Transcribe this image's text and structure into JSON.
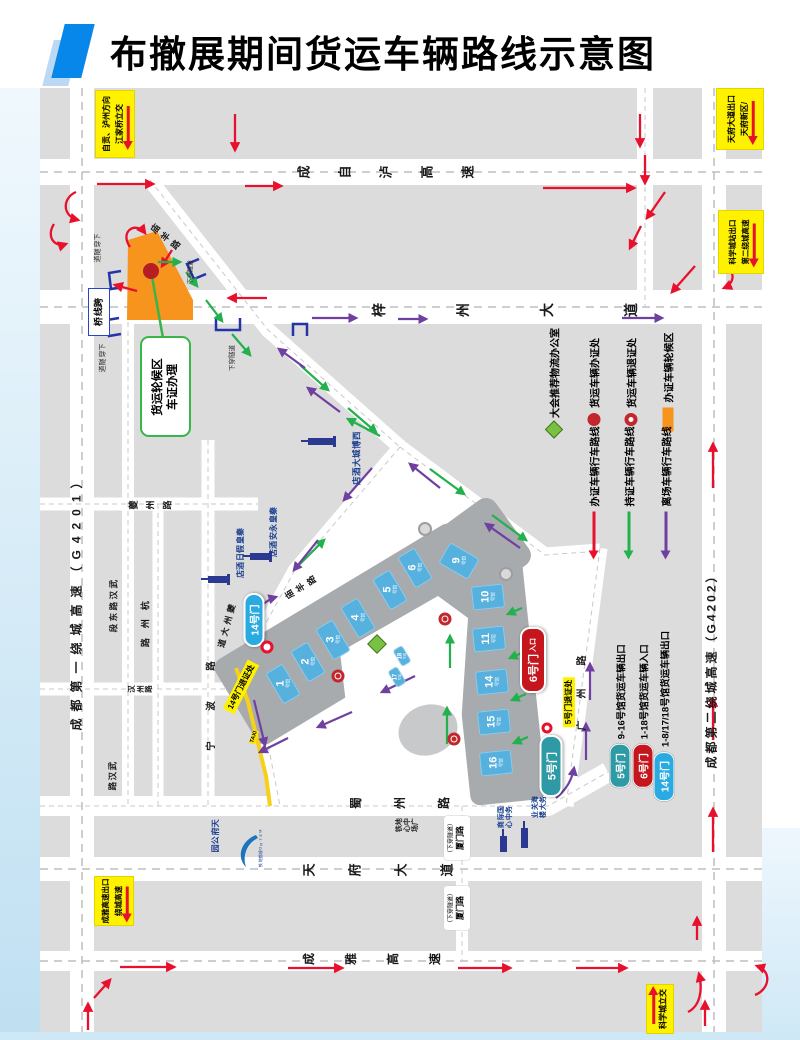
{
  "title": {
    "text": "布撤展期间货运车辆路线示意图"
  },
  "roads": {
    "chengzilu": "成自泸高速",
    "zizhou": "梓州大道",
    "g4201": "成都第一绕城高速（G4201）",
    "g4202": "成都第二绕城高速（G4202）",
    "wuhan_east": "武汉路东段",
    "wuhan": "武汉路",
    "kuizhou_rd": "夔州路",
    "hangzhou": "杭州路",
    "hanzhou": "汉州路",
    "ningbo": "宁波路",
    "kuizhou_ave": "夔州大道",
    "miaoyang": "庙羊路",
    "guangzhou": "广州路",
    "shuzhou": "蜀州路",
    "tianfu": "天府大道",
    "chengya": "成雅高速"
  },
  "exit_labels": {
    "jiangjiaqiao": {
      "lines": [
        "江家桥立交",
        "自贡、泸州方向"
      ]
    },
    "tianfu_exit": {
      "lines": [
        "天府新区/",
        "天府大道出口"
      ]
    },
    "second_ring_exit": {
      "lines": [
        "第二绕城高速",
        "科学城站出口"
      ]
    },
    "chengya_exit": {
      "lines": [
        "绕城高速",
        "成雅高速出口"
      ]
    },
    "kexuecheng": {
      "text": "科学城立交"
    }
  },
  "waiting_area": {
    "callout_line1": "货运轮候区",
    "callout_line2": "车证办理"
  },
  "bridge_label": "跨线桥",
  "tunnel_label": "下穿隧道",
  "xiamen_tunnel": {
    "line1": "厦门路",
    "line2": "（下穿隧道）"
  },
  "pois": {
    "qinhuang_yongan": "秦皇永安酒店",
    "qinhuang_jiari": "秦皇假日酒店",
    "xibocheng_hotel": "西博城大酒店",
    "tianfu_park": "天府公园",
    "metro": "METRO成都地铁",
    "metro_plaza": {
      "c1": "地铁",
      "c2": "中心",
      "c3": "广场"
    },
    "intl_biz": {
      "c1": "国际商",
      "c2": "务中心"
    },
    "customs": {
      "c1": "海关业",
      "c2": "务大楼"
    }
  },
  "gates": {
    "gate14": {
      "label": "14号门",
      "return_label": "14号门退证处"
    },
    "gate6": {
      "label": "6号门",
      "sub": "入口"
    },
    "gate5": {
      "label": "5号门",
      "return_label": "5号门退证处"
    },
    "taxi": "TAXI"
  },
  "halls": {
    "suffix": "号馆",
    "list": [
      {
        "num": "1"
      },
      {
        "num": "2"
      },
      {
        "num": "3"
      },
      {
        "num": "4"
      },
      {
        "num": "5"
      },
      {
        "num": "6"
      },
      {
        "num": "9"
      },
      {
        "num": "10"
      },
      {
        "num": "11"
      },
      {
        "num": "14"
      },
      {
        "num": "15"
      },
      {
        "num": "16"
      },
      {
        "num": "17"
      },
      {
        "num": "18"
      }
    ]
  },
  "legend": {
    "markers": [
      {
        "icon": "diamond-icon",
        "label": "大会推荐物流办公室"
      },
      {
        "icon": "dot-icon",
        "label": "货运车辆办证处"
      },
      {
        "icon": "ring-icon",
        "label": "货运车辆退证处"
      },
      {
        "icon": "bar-icon",
        "label": "办证车辆轮候区"
      }
    ],
    "routes": [
      {
        "color": "#E8112D",
        "label": "办证车辆行车路线"
      },
      {
        "color": "#22B14C",
        "label": "持证车辆行车路线"
      },
      {
        "color": "#7040A0",
        "label": "离场车辆行车路线"
      }
    ]
  },
  "gate_legend": [
    {
      "badge": "5号门",
      "color": "#2D9AA5",
      "desc": "9-16号馆货运车辆出口"
    },
    {
      "badge": "6号门",
      "color": "#C4161C",
      "desc": "1-18号馆货运车辆入口"
    },
    {
      "badge": "14号门",
      "color": "#29ABE2",
      "desc": "1-8/17/18号馆货运车辆出口"
    }
  ],
  "colors": {
    "route_permit": "#E8112D",
    "route_holder": "#22B14C",
    "route_leave": "#7040A0",
    "waiting_zone": "#F7941D",
    "hall_blue": "#57B1DE",
    "exit_label_yellow": "#FFF200"
  }
}
